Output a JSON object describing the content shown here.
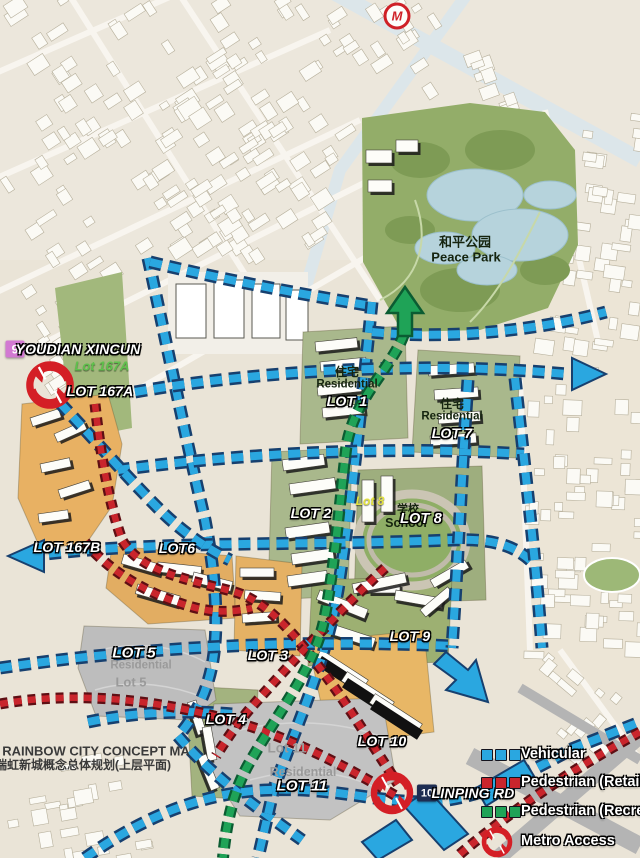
{
  "metro_logo": "M",
  "title": {
    "en": "RAINBOW CITY CONCEPT MA",
    "zh": "瑞虹新城概念总体规划(上层平面)"
  },
  "park": {
    "zh": "和平公园",
    "en": "Peace Park"
  },
  "stations": {
    "s9": {
      "num": "9",
      "name": "YOUDIAN XINCUN"
    },
    "s10": {
      "num": "10",
      "name": "LINPING RD"
    }
  },
  "lots": {
    "lot167a_sub": "Lot 167A",
    "lot167a": "LOT 167A",
    "lot167b": "LOT 167B",
    "lot1_zh": "住宅",
    "lot1_en": "Residential",
    "lot1": "LOT 1",
    "lot2": "LOT 2",
    "lot3": "LOT 3",
    "lot4": "LOT 4",
    "lot5": "LOT 5",
    "lot5_en": "Residential",
    "lot5_sub": "Lot 5",
    "lot6": "LOT6",
    "lot7_zh": "住宅",
    "lot7_en": "Residential",
    "lot7": "LOT 7",
    "lot8_sub": "Lot 8",
    "lot8_zh": "学校",
    "lot8_en": "School",
    "lot8": "LOT 8",
    "lot9": "LOT 9",
    "lot10": "LOT 10",
    "lot11_sub": "Lot 11",
    "lot11_en": "Residential",
    "lot11": "LOT 11"
  },
  "legend": {
    "items": [
      {
        "label": "Vehicular",
        "color": "#2aa7e0",
        "type": "dash"
      },
      {
        "label": "Pedestrian (Retail)",
        "color": "#c9252c",
        "type": "dash"
      },
      {
        "label": "Pedestrian (Recreation)",
        "color": "#1fa357",
        "type": "dash"
      },
      {
        "label": "Metro Access",
        "color": "#d41f26",
        "type": "metro-icon"
      }
    ]
  },
  "colors": {
    "vehicular": "#2aa7e0",
    "pedestrian_retail": "#c9252c",
    "pedestrian_recreation": "#1fa357",
    "metro_red": "#d41f26",
    "badge9": "#d279d2",
    "badge10": "#1e2d52"
  }
}
